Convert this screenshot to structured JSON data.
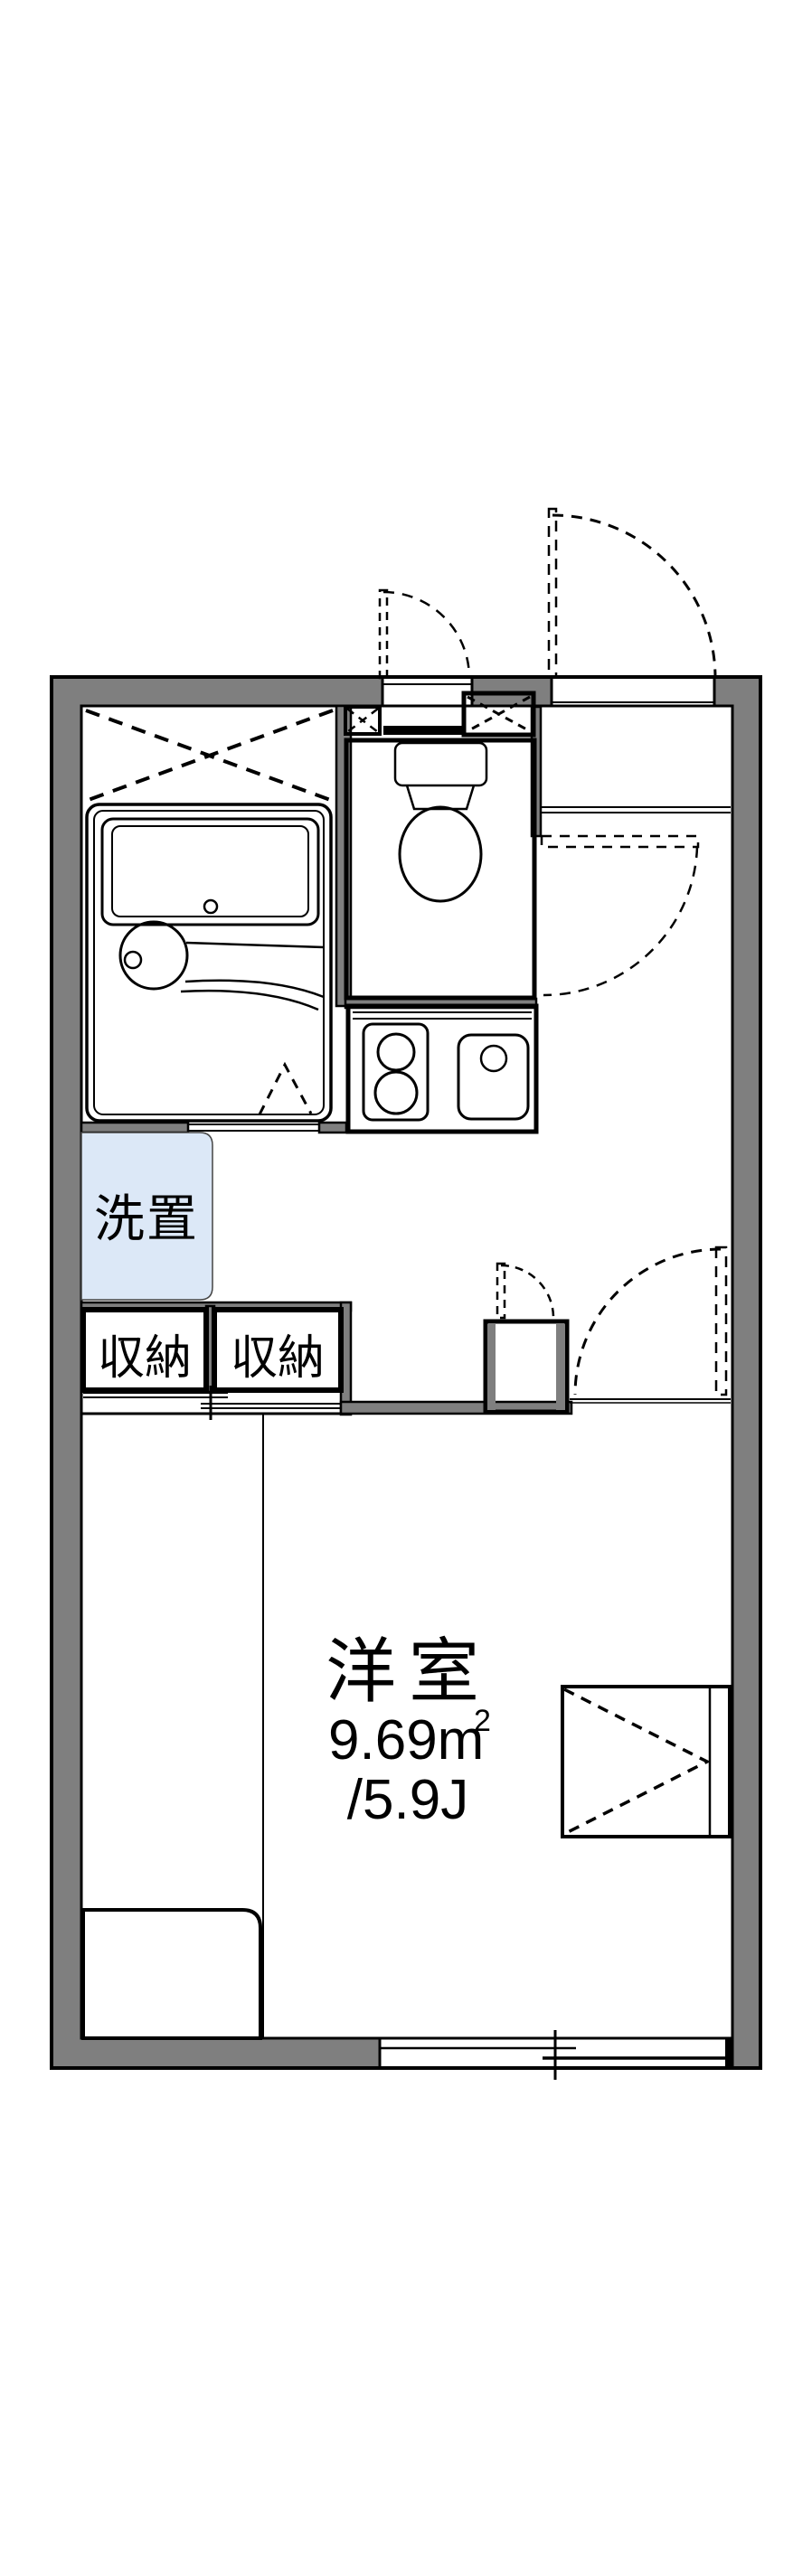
{
  "floor_plan": {
    "rooms": {
      "main_room": {
        "name": "洋室",
        "area_value": "9.69m",
        "area_superscript": "2",
        "area_tatami": "/5.9J"
      },
      "washer_place": {
        "label": "洗置"
      },
      "storage_left": {
        "label": "収納"
      },
      "storage_right": {
        "label": "収納"
      }
    },
    "colors": {
      "wall_gray": "#7f7f7f",
      "fixture_blue": "#dce8f7",
      "fixture_blue_light": "#e7effb",
      "storage_cream": "#faefd4",
      "line_black": "#000000",
      "background": "#ffffff"
    }
  }
}
